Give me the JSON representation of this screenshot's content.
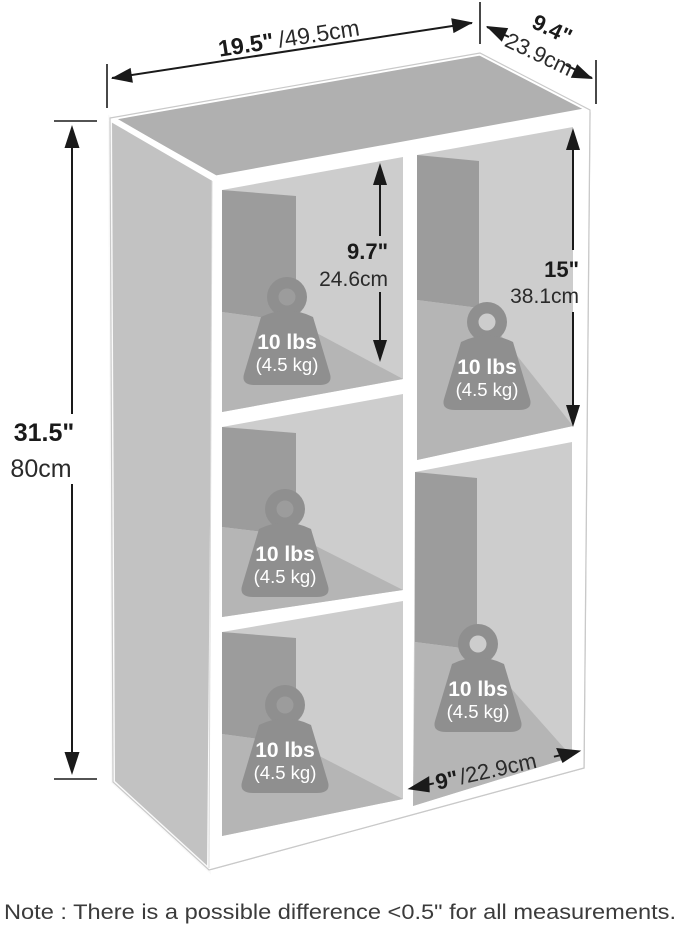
{
  "dimensions": {
    "width": {
      "in": "19.5\"",
      "cm": "/49.5cm"
    },
    "depth": {
      "in": "9.4\"",
      "cm": "23.9cm"
    },
    "height": {
      "in": "31.5\"",
      "cm": "80cm"
    },
    "small_cubby_height": {
      "in": "9.7\"",
      "cm": "24.6cm"
    },
    "large_cubby_height": {
      "in": "15\"",
      "cm": "38.1cm"
    },
    "cubby_width": {
      "in": "9\"",
      "cm": "/22.9cm"
    }
  },
  "weight_capacity": {
    "lbs": "10 lbs",
    "kg": "(4.5 kg)"
  },
  "note": "Note : There is a possible difference <0.5\" for all measurements.",
  "colors": {
    "shelf_top": "#b0b0b0",
    "shelf_side": "#c2c2c2",
    "cubby_back": "#cdcdcd",
    "cubby_wall": "#9c9c9c",
    "cubby_floor": "#b5b5b5",
    "weight_badge": "#8f8f8f",
    "dimension_ink": "#1a1a1a"
  }
}
